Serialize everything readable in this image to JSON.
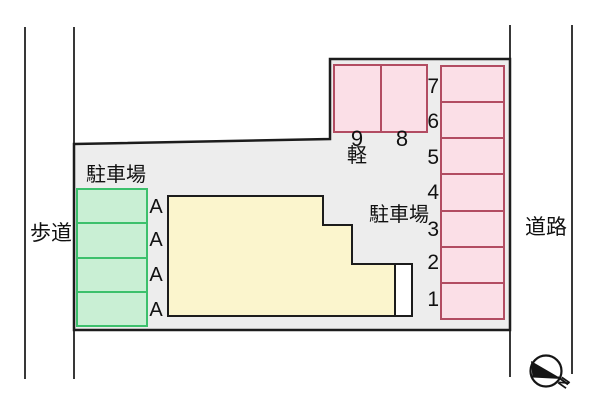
{
  "diagram": {
    "type": "parking-lot-site-plan",
    "labels": {
      "sidewalk": "歩道",
      "road": "道路",
      "parking_lot_left": "駐車場",
      "parking_lot_right": "駐車場",
      "kei_car": "軽",
      "compass_north": "N"
    },
    "parking": {
      "green_spaces": [
        {
          "label": "A"
        },
        {
          "label": "A"
        },
        {
          "label": "A"
        },
        {
          "label": "A"
        }
      ],
      "kei_spaces": [
        {
          "label": "9"
        },
        {
          "label": "8"
        }
      ],
      "numbered_spaces": [
        {
          "label": "7"
        },
        {
          "label": "6"
        },
        {
          "label": "5"
        },
        {
          "label": "4"
        },
        {
          "label": "3"
        },
        {
          "label": "2"
        },
        {
          "label": "1"
        }
      ]
    },
    "colors": {
      "parcel_fill": "#ededed",
      "outline": "#1c1c1c",
      "pink_space_fill": "#fbdfe7",
      "pink_space_border": "#b24c62",
      "green_space_fill": "#c9efd4",
      "green_space_border": "#3cc06c",
      "building_fill": "#fbf5cd",
      "porch_fill": "#ffffff"
    }
  }
}
